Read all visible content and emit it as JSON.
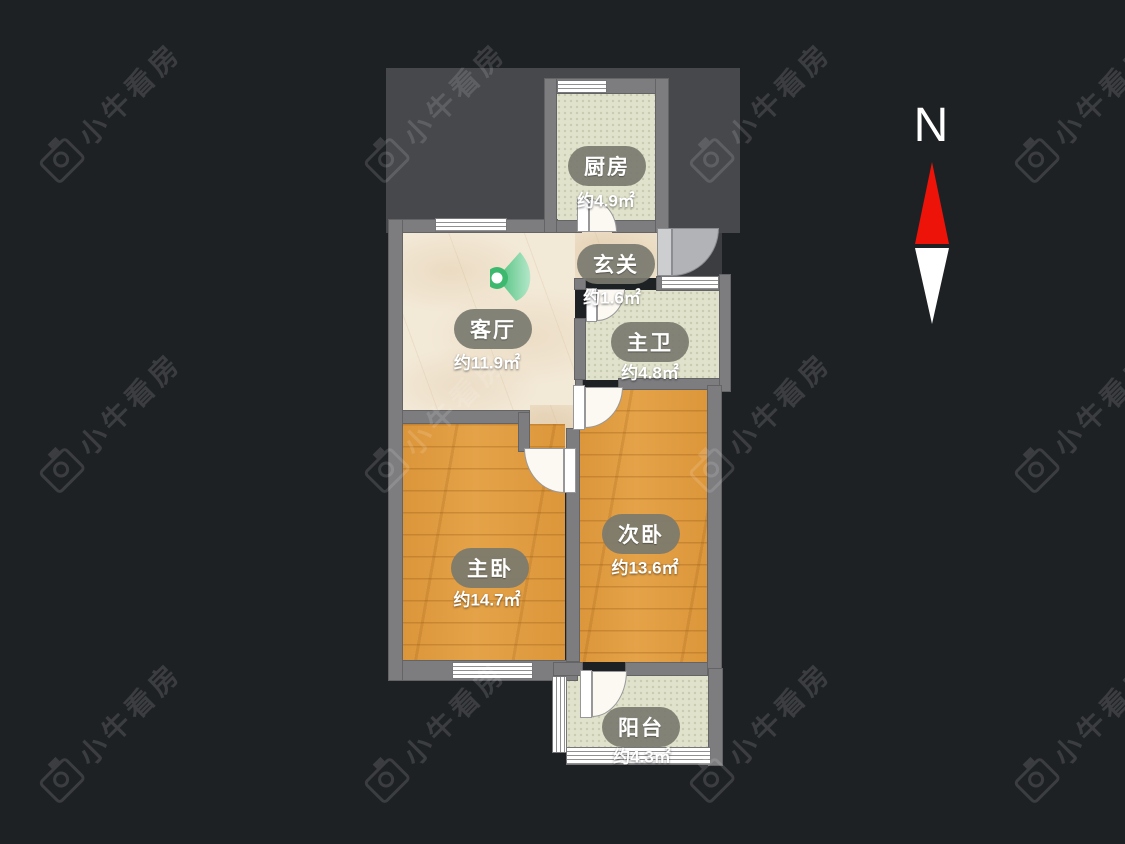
{
  "page": {
    "background_color": "#1e2124",
    "type": "floor-plan-viewer"
  },
  "watermark": {
    "text": "小牛看房",
    "icon": "camera-icon"
  },
  "compass": {
    "label": "N",
    "icon": "north-arrow-icon",
    "north_needle_color": "#ee1309",
    "south_needle_color": "#ffffff"
  },
  "floorplan": {
    "rooms": {
      "kitchen": {
        "name": "厨房",
        "area": "约4.9㎡",
        "floor": "tile"
      },
      "hallway": {
        "name": "玄关",
        "area": "约1.6㎡",
        "floor": "marble"
      },
      "living": {
        "name": "客厅",
        "area": "约11.9㎡",
        "floor": "marble"
      },
      "masterbath": {
        "name": "主卫",
        "area": "约4.8㎡",
        "floor": "tile"
      },
      "masterbed": {
        "name": "主卧",
        "area": "约14.7㎡",
        "floor": "wood"
      },
      "secondbed": {
        "name": "次卧",
        "area": "约13.6㎡",
        "floor": "wood"
      },
      "balcony": {
        "name": "阳台",
        "area": "约4.3㎡",
        "floor": "tile"
      }
    },
    "view_marker": {
      "icon": "panorama-camera-marker",
      "color": "#3cb96e"
    },
    "colors": {
      "wall": "#7d7d7f",
      "wood_floor": "#e29c3e",
      "tile_floor": "#e0e2cb",
      "marble_floor": "#f3e9d7",
      "footprint": "#46484b"
    }
  }
}
